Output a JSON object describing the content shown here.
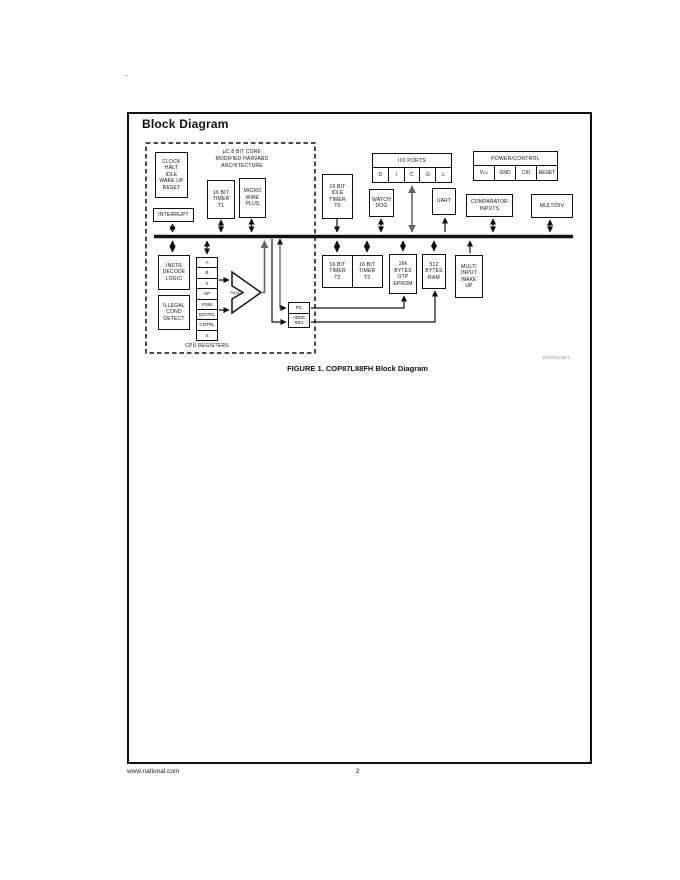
{
  "page": {
    "stray_dot": ".",
    "title": "Block Diagram",
    "caption": "FIGURE 1. COP87L88FH Block Diagram",
    "ds_number": "DS101136-1",
    "footer_left": "www.national.com",
    "footer_page": "2"
  },
  "diagram": {
    "core_title": "µC 8 BIT CORE\nMODIFIED HARVARD\nARCHITECTURE",
    "cpu_registers_label": "CPU REGISTERS",
    "alu_label": "ALU",
    "boxes": {
      "clock": "CLOCK\nHALT\nIDLE\nWAKE UP\nRESET",
      "interrupt": "INTERRUPT",
      "timer_t1": "16 BIT\nTIMER\nT1",
      "microwire": "MICRO\nWIRE\nPLUS",
      "idle_timer_t0": "16 BIT\nIDLE\nTIMER\nT0",
      "watchdog": "WATCH\nDOG",
      "uart": "UART",
      "comparator": "COMPARATOR\nINPUTS",
      "mult_div": "MULT/DIV",
      "instr_decode": "INSTR\nDECODE\nLOGIC",
      "illegal_cond": "ILLEGAL\nCOND\nDETECT",
      "timer_t2": "16 BIT\nTIMER\nT2",
      "timer_t3": "16 BIT\nTIMER\nT3",
      "eprom": "16k\nBYTES\nOTP\nEPROM",
      "ram": "512\nBYTES\nRAM",
      "multi_input": "MULTI\nINPUT\nWAKE\nUP"
    },
    "io_ports": {
      "title": "I/O PORTS",
      "cells": [
        "D",
        "I",
        "C",
        "G",
        "L"
      ]
    },
    "power_control": {
      "title": "POWER/CONTROL",
      "vcc_base": "V",
      "vcc_sub": "CC",
      "cells": [
        "GND",
        "CKI",
        "RESET"
      ]
    },
    "registers": [
      "A",
      "B",
      "X",
      "SP",
      "PSW",
      "ICNTRL",
      "CNTRL",
      "S"
    ],
    "pc_stack": [
      "PC",
      "ADDR\nREG"
    ]
  },
  "colors": {
    "line_black": "#111111",
    "line_gray": "#666666",
    "ds_number_gray": "#8a8a8a"
  }
}
